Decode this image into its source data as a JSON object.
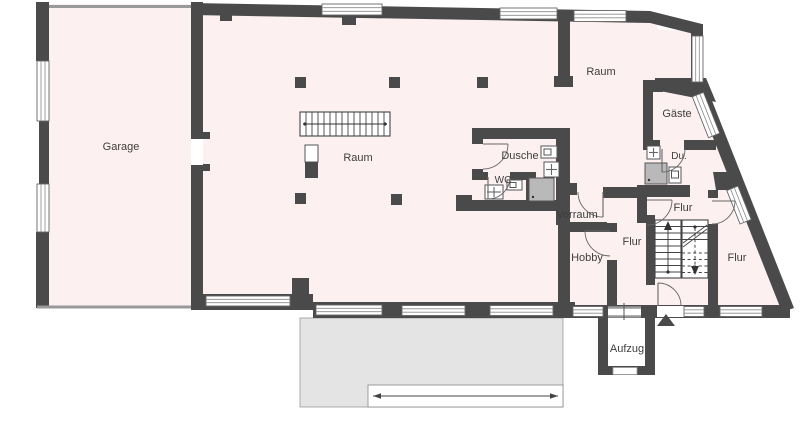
{
  "plan": {
    "rooms": {
      "garage": "Garage",
      "main_room": "Raum",
      "dusche": "Dusche",
      "wc": "WC",
      "room_right": "Raum",
      "gaeste": "Gäste",
      "du": "Du.",
      "vorraum": "Vorraum",
      "hobby": "Hobby",
      "flur_upper": "Flur",
      "flur_middle": "Flur",
      "flur_right": "Flur",
      "aufzug": "Aufzug"
    },
    "colors": {
      "wall": "#4a4a4a",
      "floor": "#fcf1f0",
      "terrace": "#e4e4e4"
    }
  }
}
